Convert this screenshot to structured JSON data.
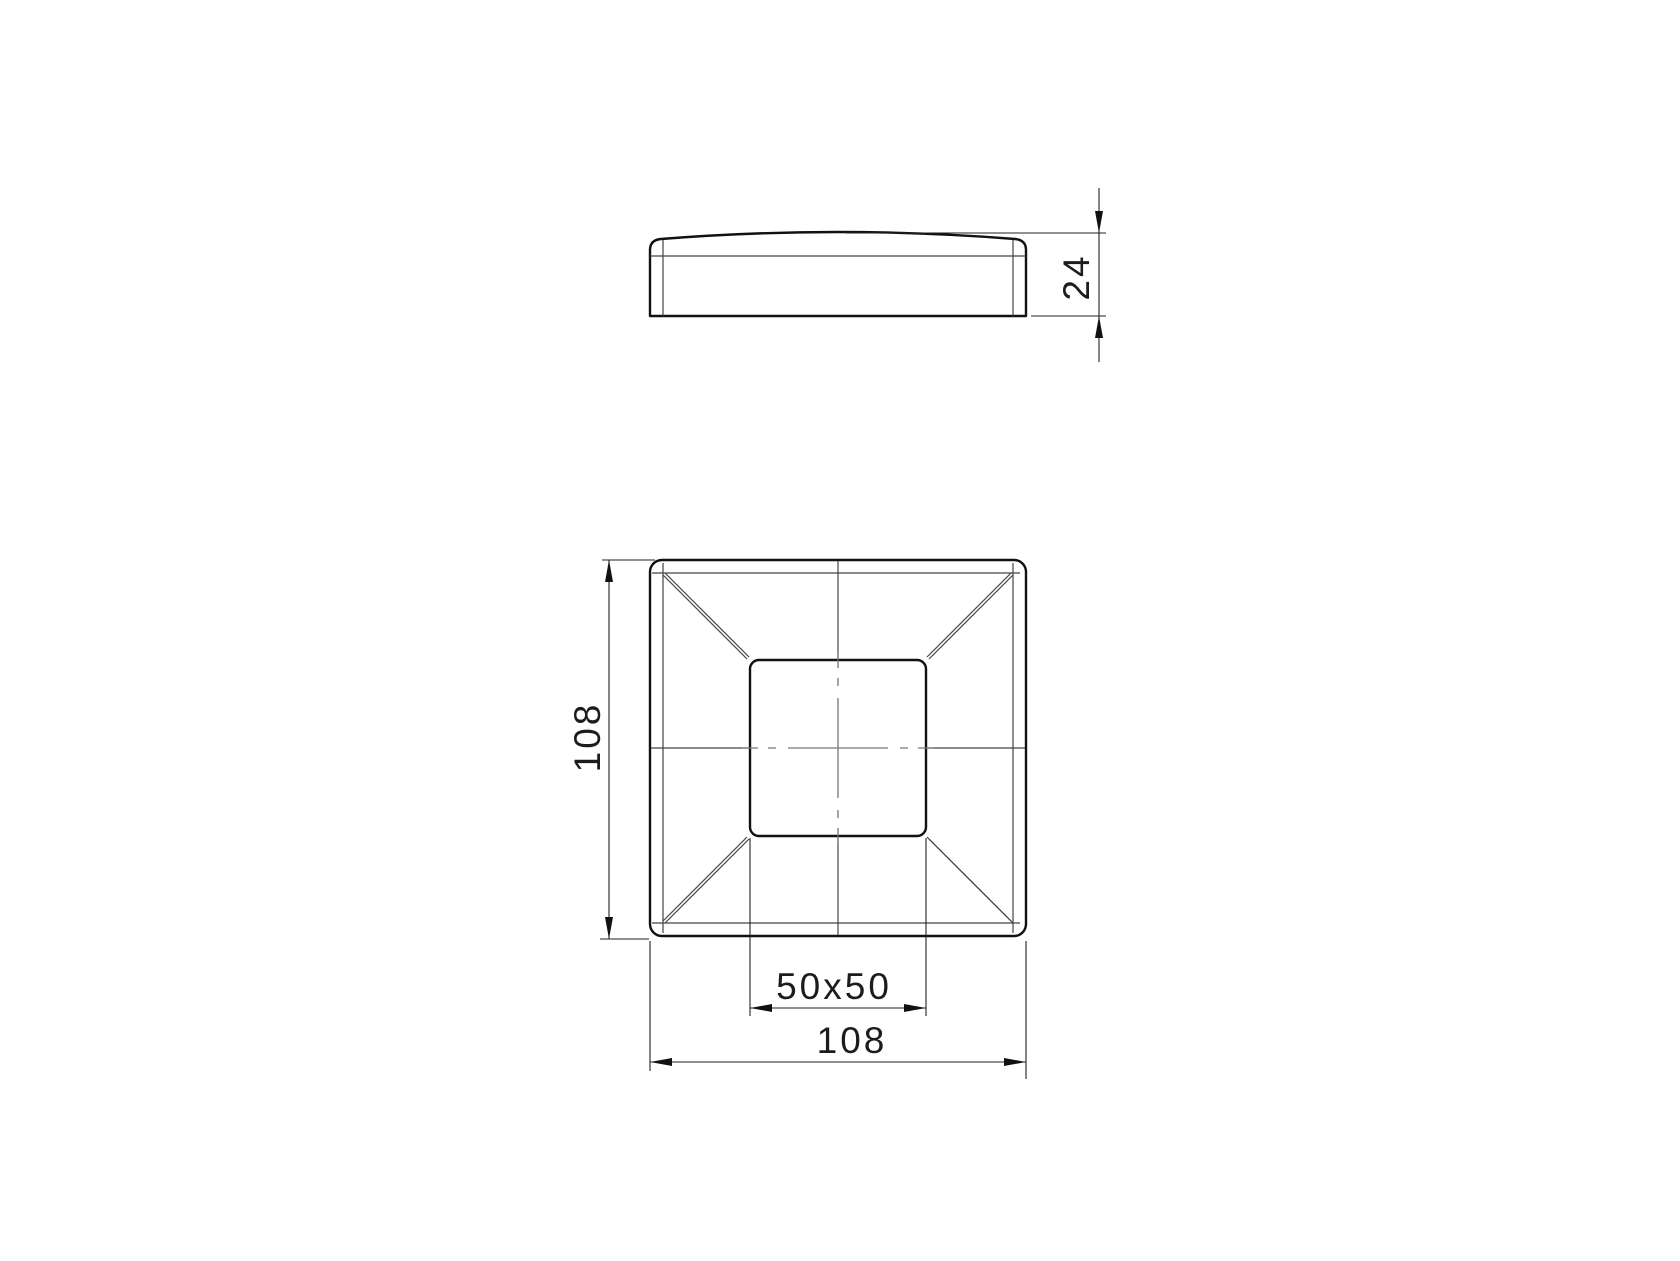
{
  "drawing": {
    "kind": "technical-drawing",
    "part": "square post cap",
    "background": "#ffffff",
    "colors": {
      "outline": "#111111",
      "thin_line": "#444444",
      "centerline": "#777777",
      "dimension_line": "#222222",
      "text": "#1c1c1c"
    },
    "dimensions": {
      "cap_height": {
        "label": "24"
      },
      "outer_size_left": {
        "label": "108"
      },
      "outer_size_bottom": {
        "label": "108"
      },
      "post_opening": {
        "label": "50x50"
      }
    }
  }
}
